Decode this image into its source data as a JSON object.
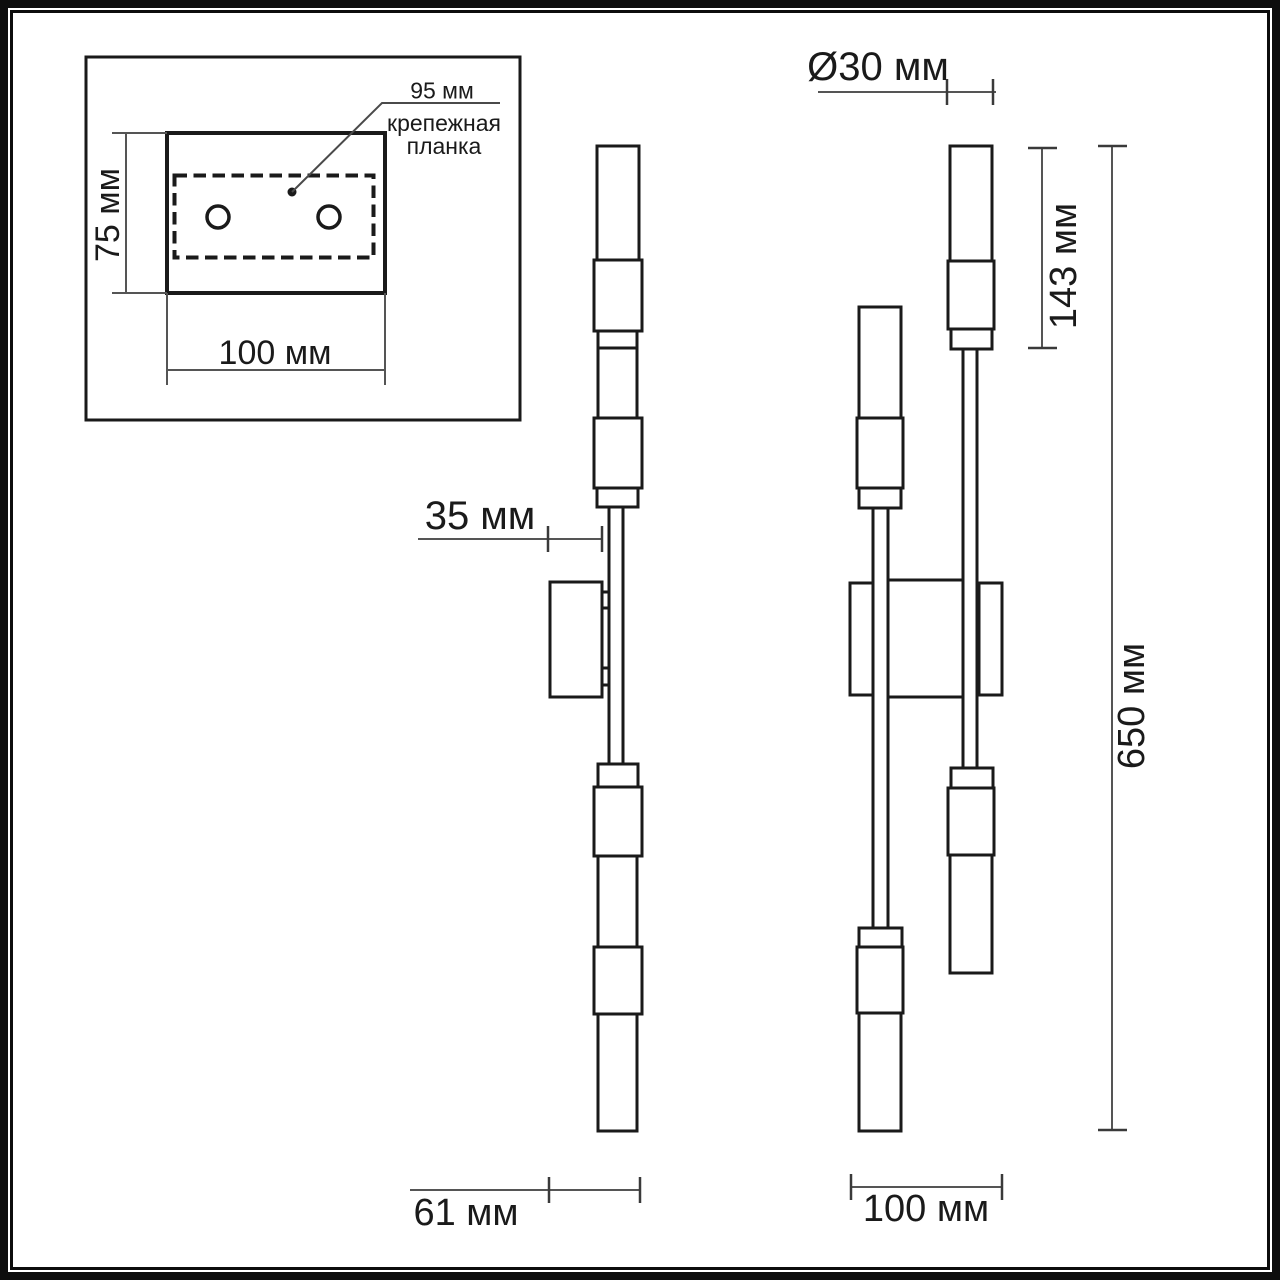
{
  "drawing": {
    "inset": {
      "hole_spacing": "95 мм",
      "plate_name_line1": "крепежная",
      "plate_name_line2": "планка",
      "plate_height": "75 мм",
      "plate_width": "100 мм"
    },
    "side_view": {
      "wall_offset": "35 мм",
      "depth": "61 мм"
    },
    "front_view": {
      "tube_diameter": "Ø30 мм",
      "shade_height": "143 мм",
      "overall_height": "650 мм",
      "width": "100 мм"
    },
    "colors": {
      "background": "#ffffff",
      "outline": "#1a1a1a",
      "dimension_line": "#555555",
      "tick": "#3a3a3a",
      "text": "#1a1a1a"
    }
  }
}
